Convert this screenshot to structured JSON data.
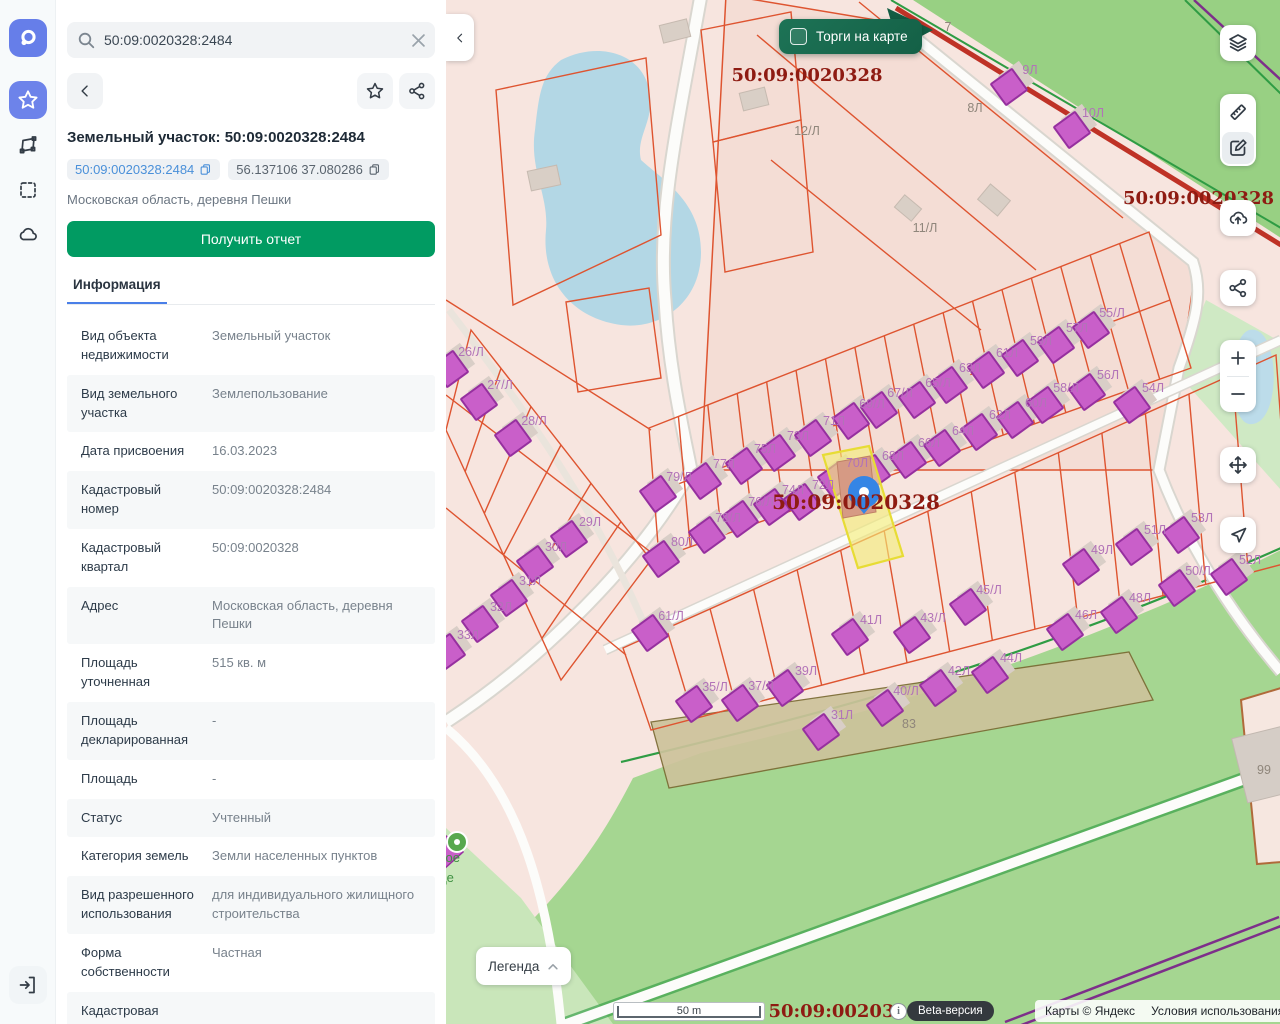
{
  "search": {
    "value": "50:09:0020328:2484",
    "icons": [
      "search-icon",
      "clear-icon"
    ]
  },
  "rail": {
    "items": [
      "app-logo",
      "favorites",
      "polygon-select",
      "area-select",
      "cloud"
    ],
    "bottom": "exit"
  },
  "panel": {
    "title": "Земельный участок: 50:09:0020328:2484",
    "chips": [
      {
        "text": "50:09:0020328:2484",
        "icon": "copy-icon"
      },
      {
        "text": "56.137106 37.080286",
        "icon": "copy-icon"
      }
    ],
    "address": "Московская область, деревня Пешки",
    "report_button": "Получить отчет",
    "tab": "Информация",
    "info_rows": [
      {
        "label": "Вид объекта недвижимости",
        "value": "Земельный участок"
      },
      {
        "label": "Вид земельного участка",
        "value": "Землепользование"
      },
      {
        "label": "Дата присвоения",
        "value": "16.03.2023"
      },
      {
        "label": "Кадастровый номер",
        "value": "50:09:0020328:2484"
      },
      {
        "label": "Кадастровый квартал",
        "value": "50:09:0020328"
      },
      {
        "label": "Адрес",
        "value": "Московская область, деревня Пешки"
      },
      {
        "label": "Площадь уточненная",
        "value": "515 кв. м"
      },
      {
        "label": "Площадь декларированная",
        "value": "-"
      },
      {
        "label": "Площадь",
        "value": "-"
      },
      {
        "label": "Статус",
        "value": "Учтенный"
      },
      {
        "label": "Категория земель",
        "value": "Земли населенных пунктов"
      },
      {
        "label": "Вид разрешенного использования",
        "value": "для индивидуального жилищного строительства"
      },
      {
        "label": "Форма собственности",
        "value": "Частная"
      },
      {
        "label": "Кадастровая",
        "value": ""
      }
    ]
  },
  "map": {
    "toggle_label": "Торги на карте",
    "legend_label": "Легенда",
    "scale_label": "50 m",
    "beta_label": "Beta-версия",
    "attribution": {
      "copyright": "Карты © Яндекс",
      "terms": "Условия использования"
    },
    "controls": [
      "layers",
      "ruler",
      "draw",
      "upload",
      "share",
      "zoom-in",
      "zoom-out",
      "pan",
      "locate"
    ],
    "colors": {
      "accent_green": "#019b62",
      "link_blue": "#4a90d9",
      "cadastral_red": "#8e1b12",
      "parcel_line": "#de5430",
      "building": "#c95fc9",
      "selection_yellow": "#f0e75e",
      "marker_blue": "#3585e5"
    },
    "labels": [
      {
        "t": "50:09:0020328",
        "x": 806,
        "y": 81,
        "c": "cad"
      },
      {
        "t": "50:09:0020328",
        "x": 1122,
        "y": 204,
        "c": "cad",
        "a": "start"
      },
      {
        "t": "50:09:0020328",
        "x": 855,
        "y": 509,
        "c": "cadbig"
      },
      {
        "t": "50:09:0020328",
        "x": 843,
        "y": 1017,
        "c": "cad"
      },
      {
        "t": "7",
        "x": 947,
        "y": 31,
        "c": "gray"
      },
      {
        "t": "8Л",
        "x": 974,
        "y": 112,
        "c": "gray"
      },
      {
        "t": "12/Л",
        "x": 806,
        "y": 135,
        "c": "gray"
      },
      {
        "t": "11/Л",
        "x": 924,
        "y": 232,
        "c": "gray"
      },
      {
        "t": "83",
        "x": 908,
        "y": 728,
        "c": "gray"
      },
      {
        "t": "99",
        "x": 1263,
        "y": 774,
        "c": "gray"
      },
      {
        "t": "9Л",
        "x": 1029,
        "y": 74,
        "c": "house",
        "b": 1
      },
      {
        "t": "10Л",
        "x": 1092,
        "y": 117,
        "c": "house",
        "b": 1
      },
      {
        "t": "26/Л",
        "x": 470,
        "y": 356,
        "c": "house",
        "b": 1
      },
      {
        "t": "27/Л",
        "x": 499,
        "y": 389,
        "c": "house",
        "b": 1
      },
      {
        "t": "28/Л",
        "x": 533,
        "y": 425,
        "c": "house",
        "b": 1
      },
      {
        "t": "29Л",
        "x": 589,
        "y": 526,
        "c": "house",
        "b": 1
      },
      {
        "t": "30Л",
        "x": 555,
        "y": 551,
        "c": "house",
        "b": 1
      },
      {
        "t": "31Л",
        "x": 529,
        "y": 585,
        "c": "house",
        "b": 1
      },
      {
        "t": "32Л",
        "x": 500,
        "y": 611,
        "c": "house",
        "b": 1
      },
      {
        "t": "33Л",
        "x": 467,
        "y": 639,
        "c": "house",
        "b": 1
      },
      {
        "t": "79/Л",
        "x": 678,
        "y": 481,
        "c": "house",
        "b": 1
      },
      {
        "t": "77Л",
        "x": 723,
        "y": 468,
        "c": "house",
        "b": 1
      },
      {
        "t": "75Л",
        "x": 764,
        "y": 453,
        "c": "house",
        "b": 1
      },
      {
        "t": "73Л",
        "x": 797,
        "y": 440,
        "c": "house",
        "b": 1
      },
      {
        "t": "71Л",
        "x": 833,
        "y": 425,
        "c": "house",
        "b": 1
      },
      {
        "t": "69/Л",
        "x": 871,
        "y": 408,
        "c": "house",
        "b": 1
      },
      {
        "t": "67/Л",
        "x": 899,
        "y": 397,
        "c": "house",
        "b": 1
      },
      {
        "t": "65/Л",
        "x": 937,
        "y": 387,
        "c": "house",
        "b": 1
      },
      {
        "t": "63Л",
        "x": 969,
        "y": 372,
        "c": "house",
        "b": 1
      },
      {
        "t": "61Л",
        "x": 1006,
        "y": 357,
        "c": "house",
        "b": 1
      },
      {
        "t": "59Л",
        "x": 1040,
        "y": 345,
        "c": "house",
        "b": 1
      },
      {
        "t": "57Л",
        "x": 1076,
        "y": 332,
        "c": "house",
        "b": 1
      },
      {
        "t": "55/Л",
        "x": 1111,
        "y": 317,
        "c": "house",
        "b": 1
      },
      {
        "t": "80Л",
        "x": 681,
        "y": 546,
        "c": "house",
        "b": 1
      },
      {
        "t": "78/Л",
        "x": 727,
        "y": 522,
        "c": "house",
        "b": 1
      },
      {
        "t": "76/Л",
        "x": 760,
        "y": 506,
        "c": "house",
        "b": 1
      },
      {
        "t": "74Л",
        "x": 792,
        "y": 494,
        "c": "house",
        "b": 1
      },
      {
        "t": "72Л",
        "x": 822,
        "y": 489,
        "c": "house",
        "b": 1
      },
      {
        "t": "70Л",
        "x": 856,
        "y": 467,
        "c": "house",
        "b": 1
      },
      {
        "t": "68Л",
        "x": 892,
        "y": 460,
        "c": "house",
        "b": 1
      },
      {
        "t": "66Л",
        "x": 928,
        "y": 447,
        "c": "house",
        "b": 1
      },
      {
        "t": "64Л",
        "x": 962,
        "y": 435,
        "c": "house",
        "b": 1
      },
      {
        "t": "62Л",
        "x": 999,
        "y": 419,
        "c": "house",
        "b": 1
      },
      {
        "t": "60Л",
        "x": 1035,
        "y": 407,
        "c": "house",
        "b": 1
      },
      {
        "t": "58/Л",
        "x": 1065,
        "y": 392,
        "c": "house",
        "b": 1
      },
      {
        "t": "56Л",
        "x": 1107,
        "y": 379,
        "c": "house",
        "b": 1
      },
      {
        "t": "54Л",
        "x": 1152,
        "y": 392,
        "c": "house",
        "b": 1
      },
      {
        "t": "61/Л",
        "x": 670,
        "y": 620,
        "c": "house",
        "b": 1
      },
      {
        "t": "35/Л",
        "x": 714,
        "y": 691,
        "c": "house",
        "b": 1
      },
      {
        "t": "37/Л",
        "x": 760,
        "y": 690,
        "c": "house",
        "b": 1
      },
      {
        "t": "39Л",
        "x": 805,
        "y": 675,
        "c": "house",
        "b": 1
      },
      {
        "t": "31Л",
        "x": 841,
        "y": 719,
        "c": "house",
        "b": 1
      },
      {
        "t": "41Л",
        "x": 870,
        "y": 624,
        "c": "house",
        "b": 1
      },
      {
        "t": "43/Л",
        "x": 932,
        "y": 622,
        "c": "house",
        "b": 1
      },
      {
        "t": "45/Л",
        "x": 988,
        "y": 594,
        "c": "house",
        "b": 1
      },
      {
        "t": "40/Л",
        "x": 905,
        "y": 695,
        "c": "house",
        "b": 1
      },
      {
        "t": "42Л",
        "x": 958,
        "y": 675,
        "c": "house",
        "b": 1
      },
      {
        "t": "44Л",
        "x": 1010,
        "y": 662,
        "c": "house",
        "b": 1
      },
      {
        "t": "46Л",
        "x": 1085,
        "y": 619,
        "c": "house",
        "b": 1
      },
      {
        "t": "48Л",
        "x": 1139,
        "y": 602,
        "c": "house",
        "b": 1
      },
      {
        "t": "49Л",
        "x": 1101,
        "y": 554,
        "c": "house",
        "b": 1
      },
      {
        "t": "51Л",
        "x": 1154,
        "y": 534,
        "c": "house",
        "b": 1
      },
      {
        "t": "53Л",
        "x": 1201,
        "y": 522,
        "c": "house",
        "b": 1
      },
      {
        "t": "50/Л",
        "x": 1197,
        "y": 575,
        "c": "house",
        "b": 1
      },
      {
        "t": "52Л",
        "x": 1249,
        "y": 564,
        "c": "house",
        "b": 1
      },
      {
        "t": "ояное",
        "x": 441,
        "y": 862,
        "c": "poi"
      },
      {
        "t": "ытце",
        "x": 438,
        "y": 882,
        "c": "poi"
      }
    ]
  }
}
